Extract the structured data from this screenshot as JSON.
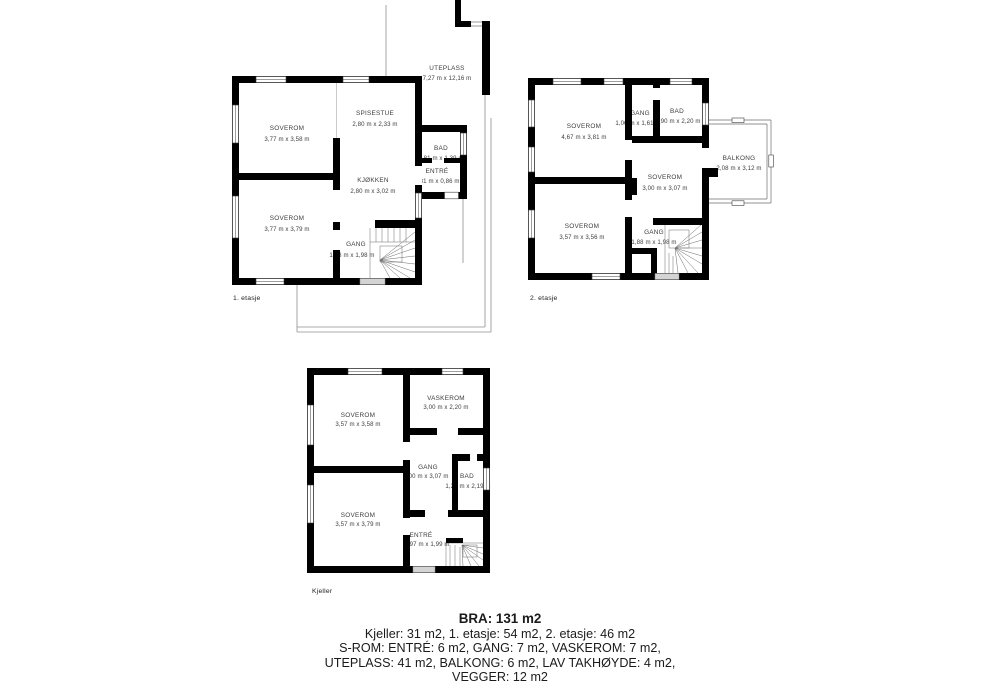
{
  "floors": {
    "f1": {
      "label": "1. etasje",
      "outdoor_name": "UTEPLASS",
      "outdoor_dims": "7,27 m x 12,16 m",
      "rooms": [
        {
          "name": "SOVEROM",
          "dims": "3,77 m x 3,58 m"
        },
        {
          "name": "SPISESTUE",
          "dims": "2,80 m x 2,33 m"
        },
        {
          "name": "BAD",
          "dims": "1,81 m x 1,39 m"
        },
        {
          "name": "ENTRÉ",
          "dims": "1,81 m x 0,86 m"
        },
        {
          "name": "KJØKKEN",
          "dims": "2,80 m x 3,02 m"
        },
        {
          "name": "SOVEROM",
          "dims": "3,77 m x 3,79 m"
        },
        {
          "name": "GANG",
          "dims": "1,68 m x 1,98 m"
        }
      ]
    },
    "f2": {
      "label": "2. etasje",
      "outdoor_name": "BALKONG",
      "outdoor_dims": "2,08 m x 3,12 m",
      "rooms": [
        {
          "name": "SOVEROM",
          "dims": "4,67 m x 3,81 m"
        },
        {
          "name": "GANG",
          "dims": "1,00 m x 1,61 m"
        },
        {
          "name": "BAD",
          "dims": "1,90 m x 2,20 m"
        },
        {
          "name": "SOVEROM",
          "dims": "3,00 m x 3,07 m"
        },
        {
          "name": "SOVEROM",
          "dims": "3,57 m x 3,56 m"
        },
        {
          "name": "GANG",
          "dims": "1,88 m x 1,98 m"
        }
      ]
    },
    "kj": {
      "label": "Kjeller",
      "rooms": [
        {
          "name": "SOVEROM",
          "dims": "3,57 m x 3,58 m"
        },
        {
          "name": "VASKEROM",
          "dims": "3,00 m x 2,20 m"
        },
        {
          "name": "GANG",
          "dims": "3,00 m x 3,07 m"
        },
        {
          "name": "BAD",
          "dims": "1,21 m x 2,19 m"
        },
        {
          "name": "SOVEROM",
          "dims": "3,57 m x 3,79 m"
        },
        {
          "name": "ENTRÉ",
          "dims": "1,97 m x 1,99 m"
        }
      ]
    }
  },
  "summary": {
    "bra": "BRA: 131 m2",
    "line1": "Kjeller: 31 m2, 1. etasje: 54 m2, 2. etasje: 46 m2",
    "line2": "S-ROM: ENTRÉ: 6 m2, GANG: 7 m2, VASKEROM: 7 m2,",
    "line3": "UTEPLASS: 41 m2, BALKONG: 6 m2, LAV TAKHØYDE: 4 m2,",
    "line4": "VEGGER: 12 m2"
  },
  "colors": {
    "wall": "#000000",
    "text": "#3d3d3d",
    "door_gray": "#d4d4d4"
  }
}
